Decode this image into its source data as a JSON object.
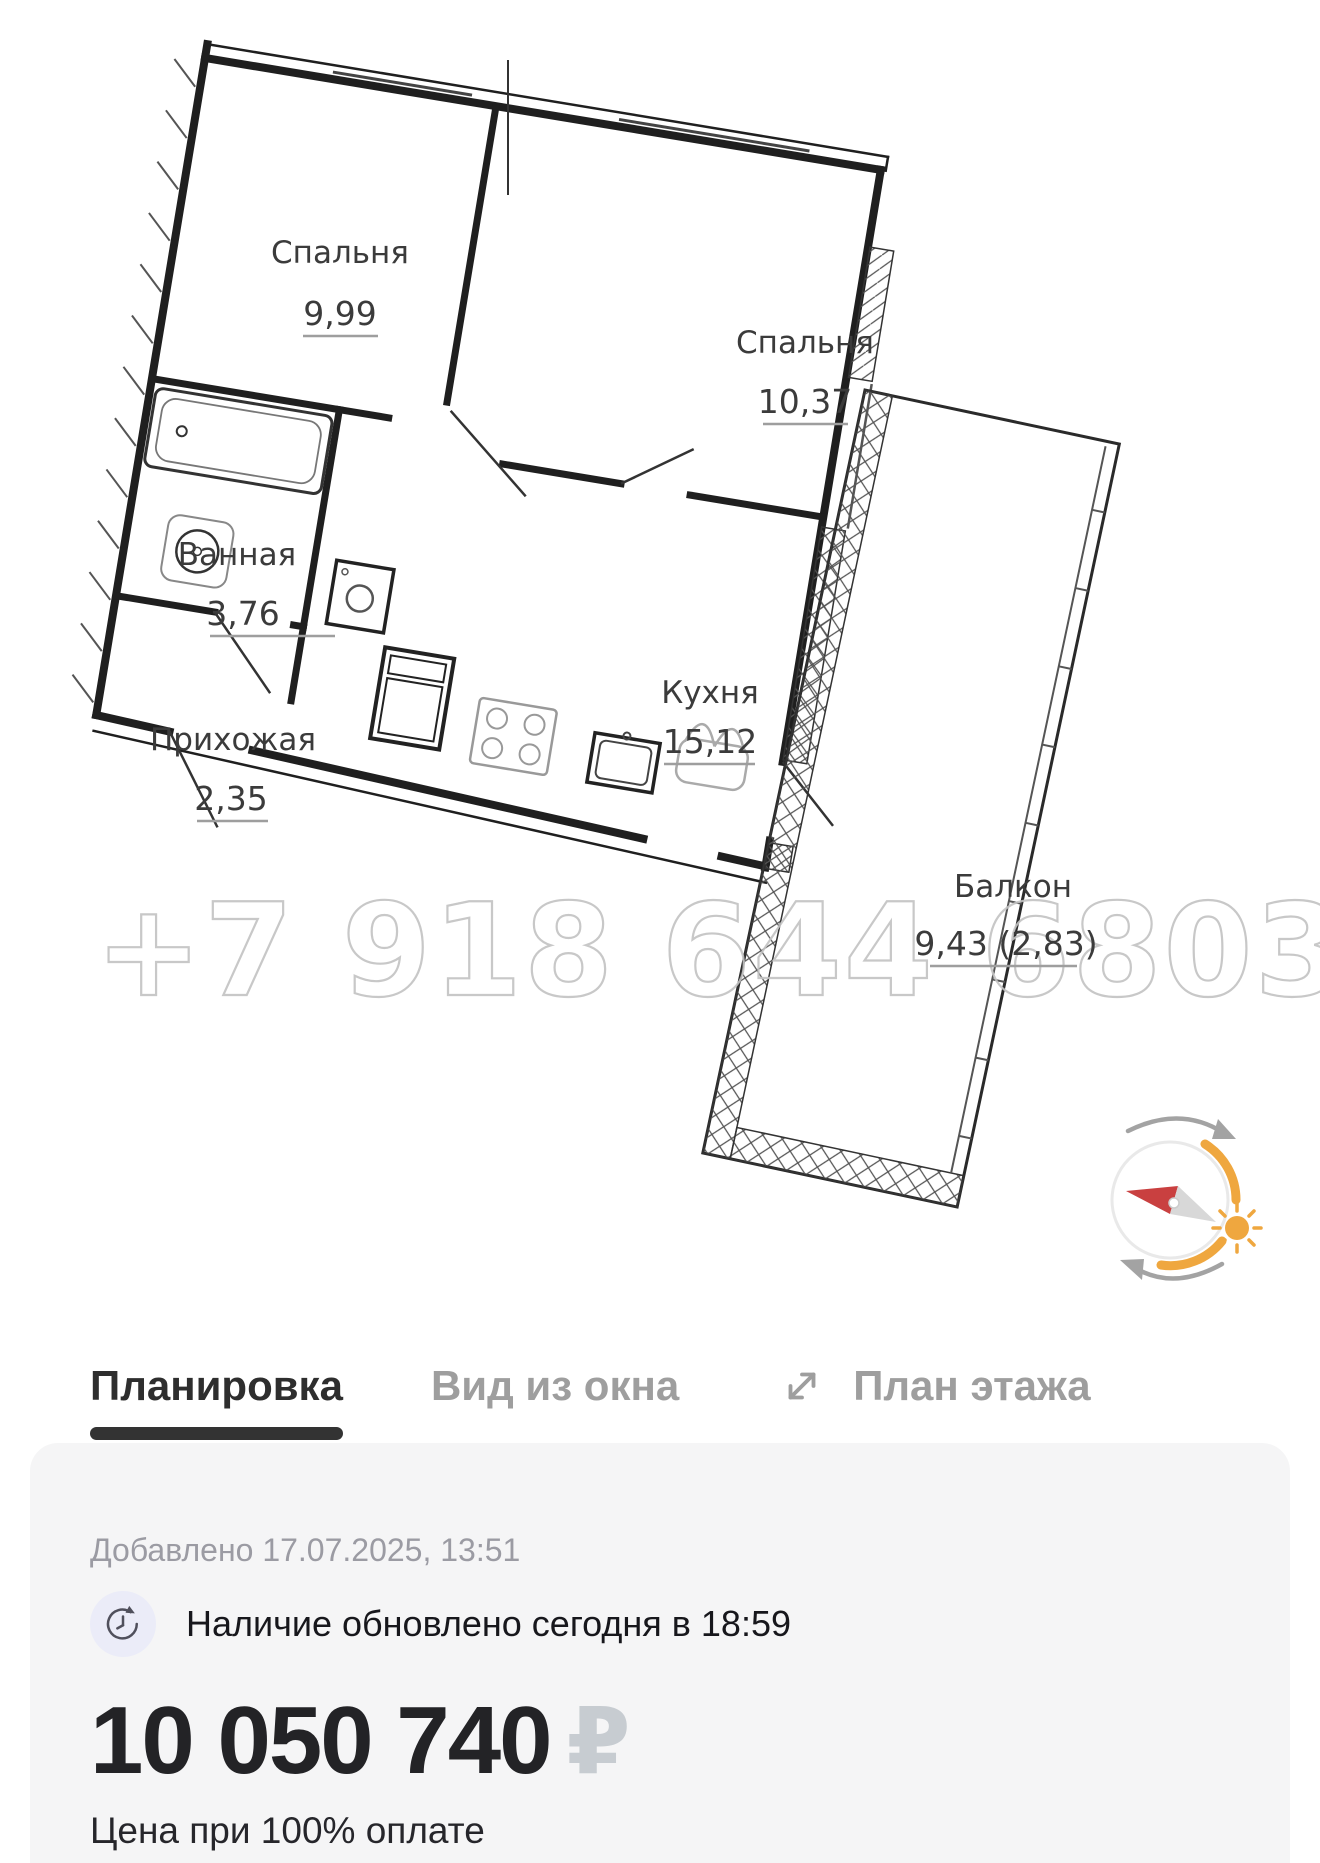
{
  "floor_plan": {
    "watermark": "+7 918 644 6803",
    "rooms": [
      {
        "name": "Спальня",
        "area": "9,99"
      },
      {
        "name": "Спальня",
        "area": "10,37"
      },
      {
        "name": "Ванная",
        "area": "3,76"
      },
      {
        "name": "Прихожая",
        "area": "2,35"
      },
      {
        "name": "Кухня",
        "area": "15,12"
      },
      {
        "name": "Балкон",
        "area": "9,43 (2,83)"
      }
    ]
  },
  "tabs": {
    "plan": "Планировка",
    "view": "Вид из окна",
    "floor": "План этажа"
  },
  "listing": {
    "added": "Добавлено 17.07.2025, 13:51",
    "availability": "Наличие обновлено сегодня в 18:59",
    "price": "10 050 740",
    "currency": "₽",
    "price_note": "Цена при 100% оплате"
  },
  "colors": {
    "accent_orange": "#efa73f",
    "needle_red": "#c94040",
    "tab_active": "#2e2e2e",
    "tab_inactive": "#9e9e9e",
    "card_bg": "#f5f5f6"
  }
}
